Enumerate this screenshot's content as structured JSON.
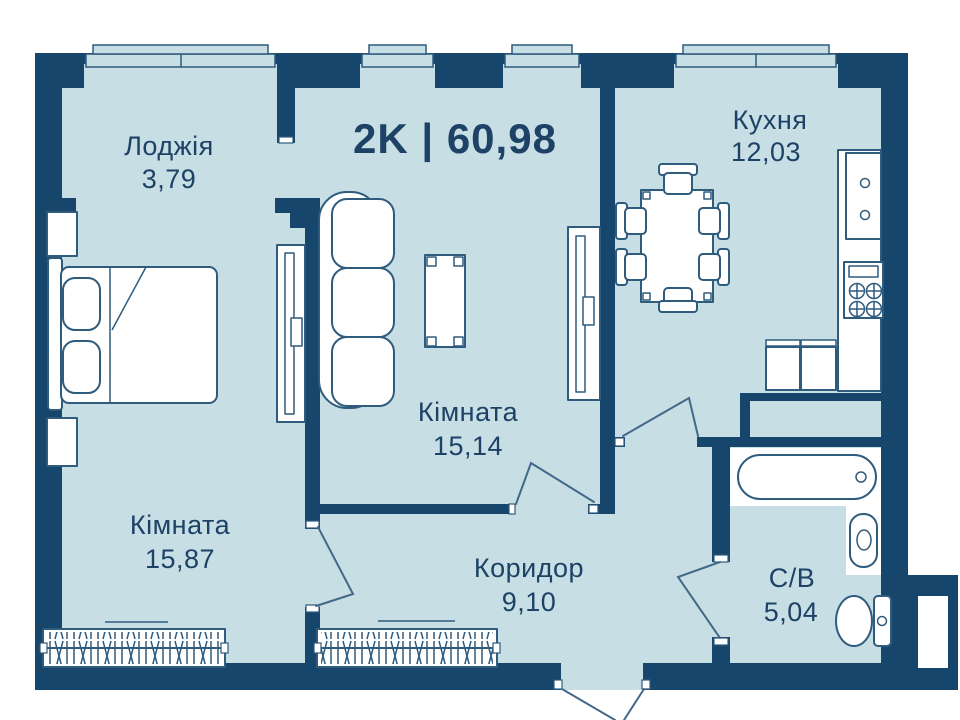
{
  "title": "2K | 60,98",
  "rooms": [
    {
      "name": "Лоджія",
      "area": "3,79"
    },
    {
      "name": "Кухня",
      "area": "12,03"
    },
    {
      "name": "Кімната",
      "area": "15,14"
    },
    {
      "name": "Кімната",
      "area": "15,87"
    },
    {
      "name": "Коридор",
      "area": "9,10"
    },
    {
      "name": "С/В",
      "area": "5,04"
    }
  ],
  "colors": {
    "wall": "#17466D",
    "floor": "#C6DEE4",
    "outline": "#2F5B7D",
    "doorline": "#44688A",
    "text": "#1D4266",
    "white": "#FFFFFF",
    "bg": "#FFFFFF"
  }
}
